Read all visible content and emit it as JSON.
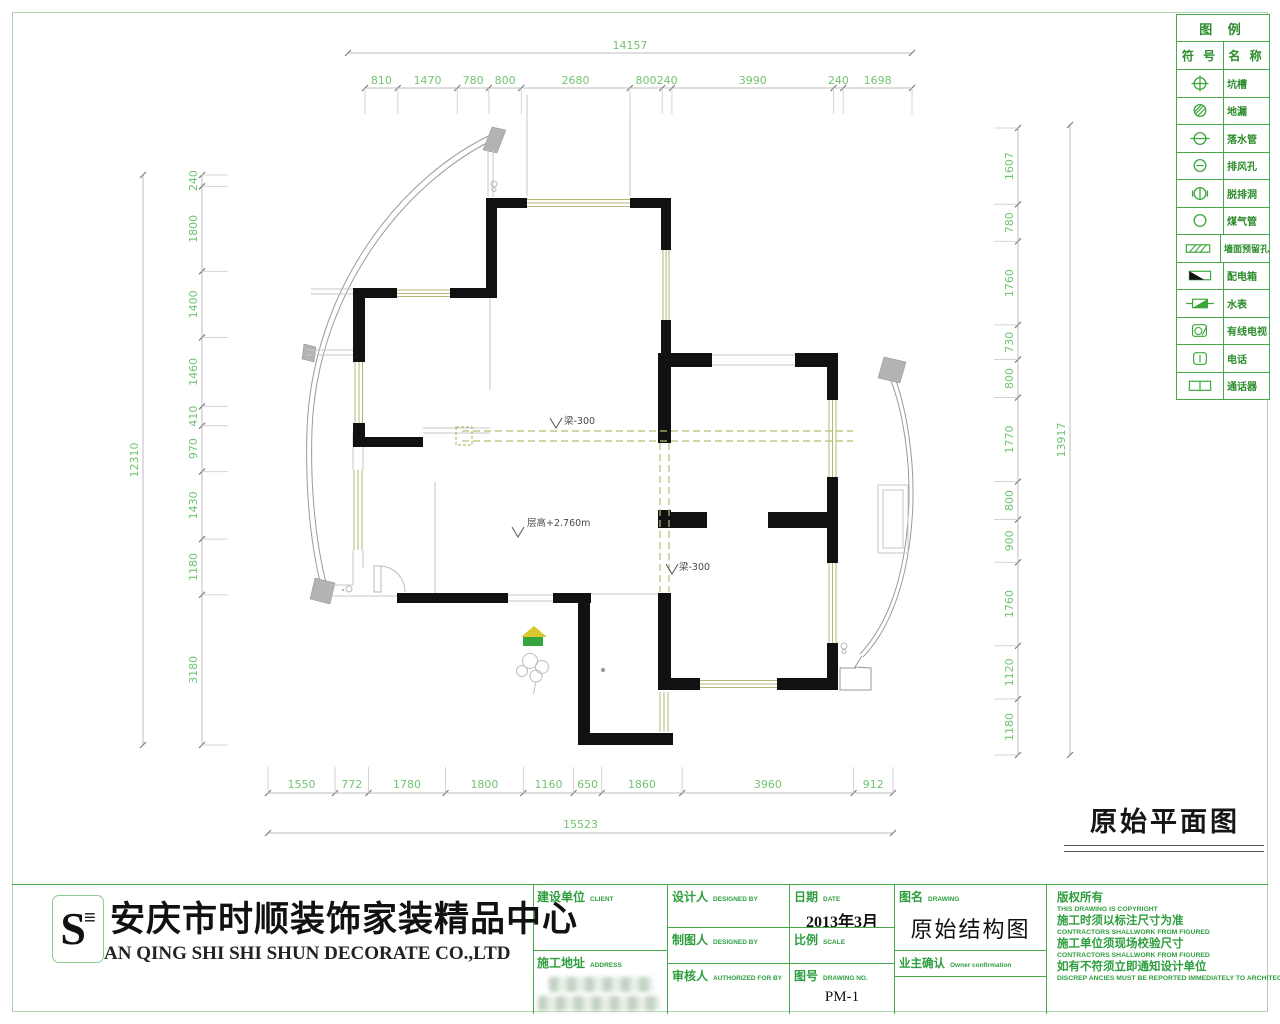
{
  "drawing_title": "原始平面图",
  "legend": {
    "title": "图 例",
    "col_symbol": "符 号",
    "col_name": "名 称",
    "rows": [
      {
        "symbol": "pit",
        "name": "坑槽"
      },
      {
        "symbol": "floor-drain",
        "name": "地漏"
      },
      {
        "symbol": "downpipe",
        "name": "落水管"
      },
      {
        "symbol": "vent",
        "name": "排风孔"
      },
      {
        "symbol": "hood-hole",
        "name": "脱排洞"
      },
      {
        "symbol": "gas-pipe",
        "name": "煤气管"
      },
      {
        "symbol": "wall-hole",
        "name": "墙面预留孔"
      },
      {
        "symbol": "power-box",
        "name": "配电箱"
      },
      {
        "symbol": "water-meter",
        "name": "水表"
      },
      {
        "symbol": "cable-tv",
        "name": "有线电视"
      },
      {
        "symbol": "telephone",
        "name": "电话"
      },
      {
        "symbol": "intercom",
        "name": "通话器"
      }
    ]
  },
  "plan": {
    "labels": {
      "beam": "梁-300",
      "floor_height": "层高+2.760m"
    },
    "dimensions": {
      "top_overall": [
        "14157"
      ],
      "top_segments": [
        "810",
        "1470",
        "780",
        "800",
        "2680",
        "800",
        "240",
        "3990",
        "240",
        "1698"
      ],
      "left_overall": [
        "12310"
      ],
      "left_segments": [
        "240",
        "1800",
        "1400",
        "1460",
        "410",
        "970",
        "1430",
        "1180",
        "3180"
      ],
      "right_overall": [
        "13917"
      ],
      "right_segments": [
        "1607",
        "780",
        "1760",
        "730",
        "800",
        "1770",
        "800",
        "900",
        "1760",
        "1120",
        "1180"
      ],
      "bottom_overall": [
        "15523"
      ],
      "bottom_segments": [
        "1550",
        "772",
        "1780",
        "1800",
        "1160",
        "650",
        "1860",
        "3960",
        "912"
      ]
    }
  },
  "company": {
    "logo_text": "S",
    "name_cn": "安庆市时顺装饰家装精品中心",
    "name_en": "AN QING SHI SHI SHUN DECORATE CO.,LTD"
  },
  "titleblock": {
    "client_label": "建设单位",
    "client_label_en": "CLIENT",
    "address_label": "施工地址",
    "address_label_en": "ADDRESS",
    "designer_label": "设计人",
    "designer_label_en": "DESIGNED BY",
    "drafter_label": "制图人",
    "drafter_label_en": "DESIGNED BY",
    "checker_label": "审核人",
    "checker_label_en": "AUTHORIZED FOR BY",
    "date_label": "日期",
    "date_label_en": "DATE",
    "date_value": "2013年3月",
    "scale_label": "比例",
    "scale_label_en": "SCALE",
    "drawing_no_label": "图号",
    "drawing_no_label_en": "DRAWING NO.",
    "drawing_no_value": "PM-1",
    "drawing_name_label": "图名",
    "drawing_name_label_en": "DRAWING",
    "drawing_name_value": "原始结构图",
    "owner_label": "业主确认",
    "owner_label_en": "Owner confirmation",
    "notes": [
      {
        "cn": "版权所有",
        "en": "THIS DRAWING IS COPYRIGHT"
      },
      {
        "cn": "施工时须以标注尺寸为准",
        "en": "CONTRACTORS SHALLWORK FROM FIGURED"
      },
      {
        "cn": "施工单位须现场校验尺寸",
        "en": "CONTRACTORS SHALLWORK FROM FIGURED"
      },
      {
        "cn": "如有不符须立即通知设计单位",
        "en": "DISCREP ANCIES MUST BE REPORTED IMMEDIATELY TO ARCHITECTS"
      }
    ]
  },
  "colors": {
    "accent_green": "#3aa63a",
    "dim_green": "#72c372",
    "wall_black": "#111111",
    "window_olive": "#b5b578",
    "beam_olive": "#b3bd6e",
    "hatch_gray": "#b3b3b3"
  }
}
